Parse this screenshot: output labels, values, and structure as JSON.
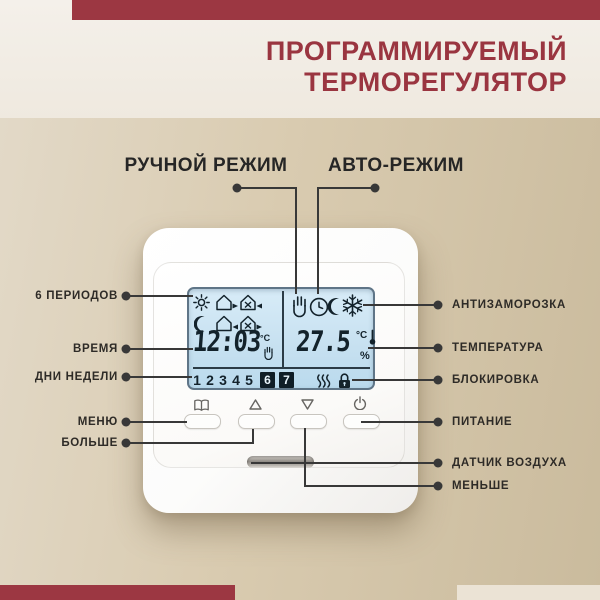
{
  "header": {
    "title_line1": "ПРОГРАММИРУЕМЫЙ",
    "title_line2": "ТЕРМОРЕГУЛЯТОР"
  },
  "modes": {
    "manual": "РУЧНОЙ РЕЖИМ",
    "auto": "АВТО-РЕЖИМ"
  },
  "callouts": {
    "left": [
      "6 ПЕРИОДОВ",
      "ВРЕМЯ",
      "ДНИ НЕДЕЛИ",
      "МЕНЮ",
      "БОЛЬШЕ"
    ],
    "right": [
      "АНТИЗАМОРОЗКА",
      "ТЕМПЕРАТУРА",
      "БЛОКИРОВКА",
      "ПИТАНИЕ",
      "ДАТЧИК ВОЗДУХА",
      "МЕНЬШЕ"
    ]
  },
  "display": {
    "time": "12:03",
    "time_unit": "°C",
    "temperature": "27.5",
    "temp_unit": "°C",
    "percent": "%",
    "weekdays": [
      "1",
      "2",
      "3",
      "4",
      "5",
      "6",
      "7"
    ],
    "active_weekdays": [
      "6",
      "7"
    ],
    "left_icons": [
      "sun",
      "house-exit",
      "house-enter-x",
      "moon",
      "house-enter",
      "house-exit-x"
    ],
    "right_icons": [
      "hand-manual",
      "clock-auto",
      "moon-night",
      "snowflake-antifreeze"
    ],
    "status_icons": [
      "heating-waves",
      "lock"
    ]
  },
  "buttons": [
    {
      "icon": "menu-book"
    },
    {
      "icon": "arrow-up"
    },
    {
      "icon": "arrow-down"
    },
    {
      "icon": "power"
    }
  ],
  "colors": {
    "accent_red": "#9c3742",
    "title_red": "#9a3540",
    "lcd_blue": "#c6e0f0",
    "background_tan": "#d2c3a7",
    "line_ink": "#383838"
  }
}
